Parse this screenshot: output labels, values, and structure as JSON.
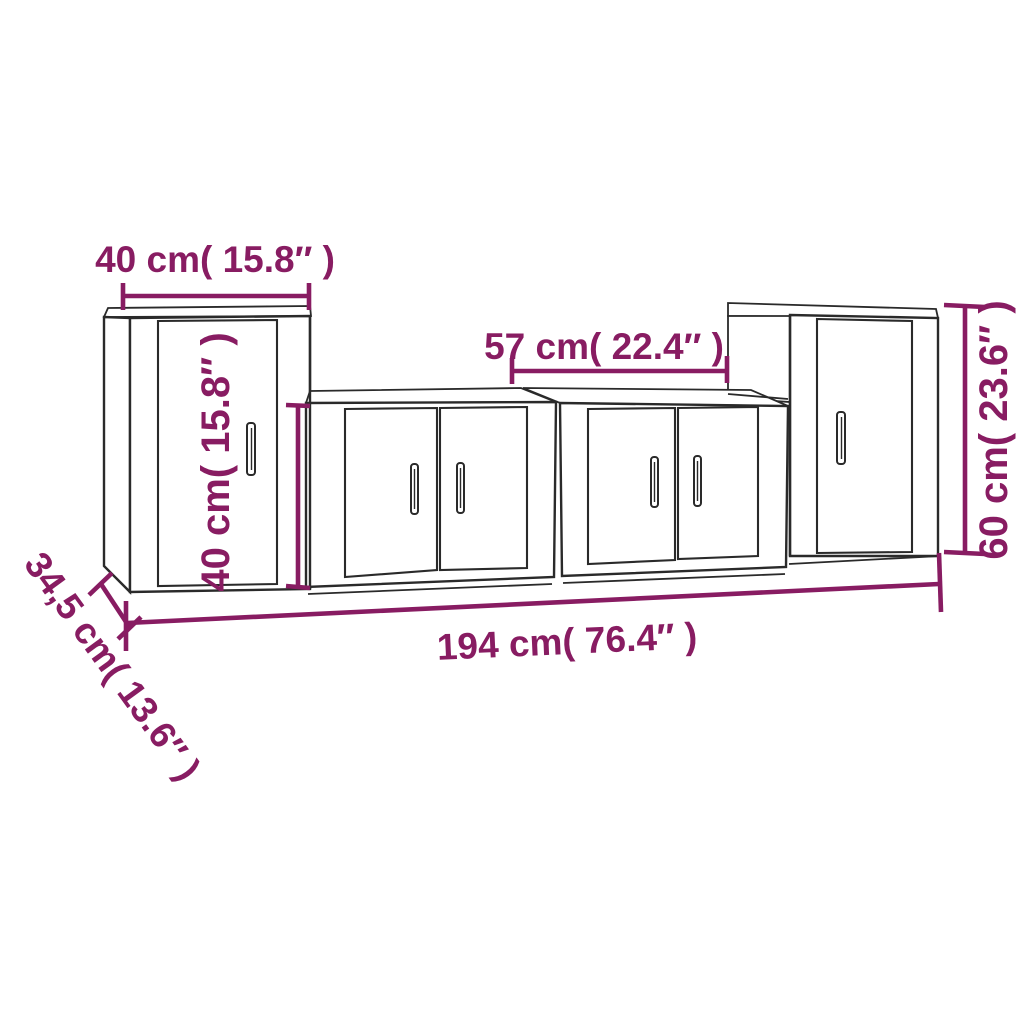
{
  "page": {
    "background": "#ffffff",
    "description": "Dimension diagram of a 4-piece wall-mounted TV cabinet set"
  },
  "diagram": {
    "accent_color": "#881c62",
    "line_color": "#2a2a2a",
    "labels": {
      "left_cabinet_width": "40 cm( 15.8″ )",
      "middle_cabinet_height": "40 cm( 15.8″ )",
      "middle_cabinet_width": "57 cm( 22.4″ )",
      "right_cabinet_height": "60 cm( 23.6″ )",
      "total_width": "194 cm( 76.4″ )",
      "depth": "34,5 cm( 13.6″ )"
    },
    "cabinets": [
      {
        "name": "left-tall-cabinet",
        "doors": 1
      },
      {
        "name": "middle-left-cabinet",
        "doors": 2
      },
      {
        "name": "middle-right-cabinet",
        "doors": 2
      },
      {
        "name": "right-tall-cabinet",
        "doors": 1
      }
    ]
  }
}
